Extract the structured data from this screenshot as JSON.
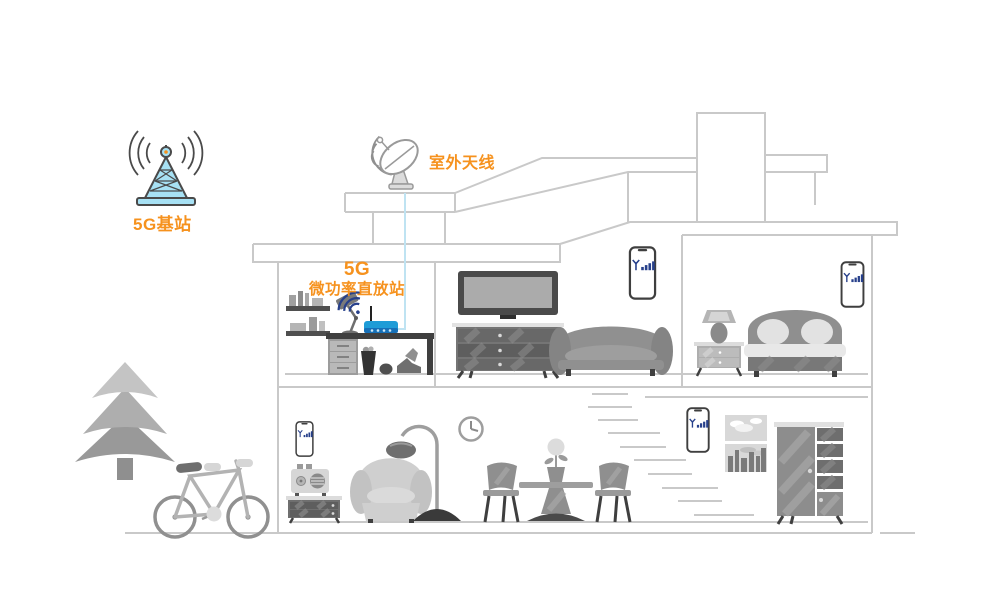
{
  "illustration": {
    "labels": {
      "base_station": "5G基站",
      "outdoor_antenna": "室外天线",
      "repeater_line1": "5G",
      "repeater_line2": "微功率直放站"
    },
    "colors": {
      "accent_orange": "#F6921E",
      "tower_fill_cyan": "#A7E1F4",
      "tower_outline": "#4A4A4A",
      "router_blue": "#1E9CD7",
      "router_band_blue": "#1670B8",
      "cable_light_blue": "#BFE3F2",
      "signal_navy": "#27408B",
      "house_outline_gray": "#C9C9C9",
      "furniture_gray": "#8F8F8F"
    },
    "icons": [
      "base-station-tower-icon",
      "radio-waves-icon",
      "satellite-dish-icon",
      "wifi-signal-icon",
      "router-icon",
      "phone-signal-icon"
    ],
    "phones_with_signal_count": 4,
    "scene_objects": [
      "5g-base-station",
      "pine-tree",
      "bicycle",
      "outdoor-antenna",
      "coax-cable",
      "wall-shelves",
      "desk-lamp",
      "wifi-router",
      "desk",
      "trash-can",
      "ball",
      "sneakers",
      "tv",
      "tv-cabinet",
      "sofa",
      "smartphone",
      "bedside-lamp",
      "nightstand",
      "bed",
      "radio",
      "side-cabinet",
      "armchair",
      "floor-lamp",
      "wall-clock",
      "dining-chair",
      "pedestal-table",
      "potted-flower",
      "staircase",
      "picture-frames",
      "wardrobe"
    ]
  }
}
